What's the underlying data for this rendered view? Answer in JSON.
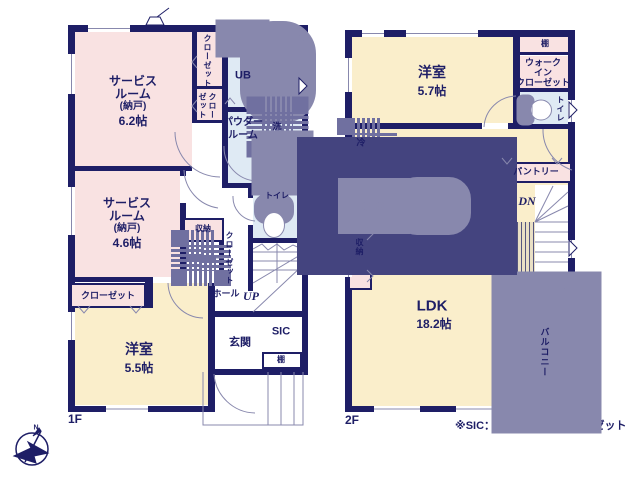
{
  "title": "Floor plan 1F/2F",
  "watermark": "ME Group",
  "footnote": "※SIC：シューズインクローゼット",
  "floor1_label": "1F",
  "floor2_label": "2F",
  "compass_label": "N",
  "colors": {
    "wall": "#1e1e66",
    "pink": "#f9e2e2",
    "yellow": "#faeecb",
    "blue": "#dfeaf4",
    "line": "#8888ad",
    "dash": "#7070a0",
    "tan": "#e9dfc4",
    "white": "#ffffff"
  },
  "rooms": [
    {
      "n": "room-service-6-2",
      "x": 75,
      "y": 32,
      "w": 117,
      "h": 136,
      "f": "pink"
    },
    {
      "n": "closet-column",
      "x": 197,
      "y": 32,
      "w": 25,
      "h": 91,
      "f": "pink"
    },
    {
      "n": "room-ub",
      "x": 228,
      "y": 32,
      "w": 73,
      "h": 75,
      "f": "blue"
    },
    {
      "n": "room-powder",
      "x": 228,
      "y": 112,
      "w": 73,
      "h": 71,
      "f": "blue"
    },
    {
      "n": "room-toilet-1f",
      "x": 253,
      "y": 188,
      "w": 48,
      "h": 50,
      "f": "blue"
    },
    {
      "n": "room-service-4-6",
      "x": 75,
      "y": 171,
      "w": 105,
      "h": 106,
      "f": "pink"
    },
    {
      "n": "room-youshitsu-5-5",
      "x": 75,
      "y": 283,
      "w": 133,
      "h": 122,
      "f": "yellow"
    },
    {
      "n": "room-youshitsu-5-7",
      "x": 352,
      "y": 37,
      "w": 161,
      "h": 86,
      "f": "yellow"
    },
    {
      "n": "room-ldk",
      "x": 352,
      "y": 129,
      "w": 160,
      "h": 277,
      "f": "yellow"
    },
    {
      "n": "room-ldk-wing",
      "x": 508,
      "y": 129,
      "w": 60,
      "h": 93,
      "f": "yellow"
    },
    {
      "n": "shelf-strip-2f",
      "x": 518,
      "y": 37,
      "w": 50,
      "h": 15,
      "f": "pink"
    },
    {
      "n": "room-wic",
      "x": 518,
      "y": 56,
      "w": 50,
      "h": 32,
      "f": "pink"
    },
    {
      "n": "room-toilet-2f",
      "x": 518,
      "y": 92,
      "w": 50,
      "h": 32,
      "f": "blue"
    },
    {
      "n": "stairs-2f-area",
      "x": 535,
      "y": 185,
      "w": 33,
      "h": 108,
      "f": "white"
    },
    {
      "n": "stairs-1f-area",
      "x": 253,
      "y": 243,
      "w": 48,
      "h": 68,
      "f": "white"
    }
  ],
  "walls": [
    [
      68,
      25,
      240,
      7
    ],
    [
      68,
      25,
      7,
      387
    ],
    [
      68,
      406,
      147,
      6
    ],
    [
      302,
      25,
      6,
      350
    ],
    [
      211,
      369,
      97,
      6
    ],
    [
      222,
      32,
      6,
      151
    ],
    [
      192,
      32,
      5,
      91
    ],
    [
      75,
      166,
      117,
      5
    ],
    [
      180,
      166,
      6,
      10
    ],
    [
      180,
      203,
      6,
      79
    ],
    [
      68,
      277,
      85,
      5
    ],
    [
      145,
      277,
      8,
      31
    ],
    [
      208,
      283,
      7,
      129
    ],
    [
      208,
      311,
      100,
      6
    ],
    [
      222,
      183,
      80,
      5
    ],
    [
      248,
      188,
      5,
      10
    ],
    [
      248,
      225,
      5,
      15
    ],
    [
      248,
      238,
      54,
      5
    ],
    [
      248,
      243,
      5,
      48
    ],
    [
      222,
      107,
      86,
      5
    ],
    [
      192,
      86,
      30,
      3
    ],
    [
      192,
      120,
      30,
      3
    ],
    [
      219,
      218,
      5,
      55
    ],
    [
      345,
      30,
      230,
      7
    ],
    [
      345,
      30,
      7,
      382
    ],
    [
      345,
      406,
      173,
      6
    ],
    [
      568,
      30,
      7,
      268
    ],
    [
      352,
      123,
      130,
      6
    ],
    [
      508,
      123,
      12,
      6
    ],
    [
      513,
      30,
      7,
      97
    ],
    [
      518,
      52,
      50,
      3
    ],
    [
      513,
      88,
      62,
      4
    ],
    [
      513,
      124,
      62,
      5
    ],
    [
      508,
      222,
      6,
      71
    ],
    [
      535,
      293,
      40,
      6
    ],
    [
      508,
      288,
      29,
      5
    ],
    [
      512,
      298,
      6,
      114
    ]
  ],
  "boxes": [
    {
      "n": "storage-box-1f",
      "x": 183,
      "y": 218,
      "w": 41,
      "h": 24,
      "f": "pink"
    },
    {
      "n": "closet-strip-1f",
      "x": 70,
      "y": 283,
      "w": 76,
      "h": 25,
      "f": "pink"
    },
    {
      "n": "shelf-box-entrance",
      "x": 262,
      "y": 352,
      "w": 40,
      "h": 17,
      "f": "white"
    },
    {
      "n": "pantry-box",
      "x": 500,
      "y": 162,
      "w": 72,
      "h": 21,
      "f": "pink"
    },
    {
      "n": "storage-box-2f",
      "x": 348,
      "y": 222,
      "w": 24,
      "h": 68,
      "f": "pink"
    }
  ],
  "stripe_panel": {
    "n": "stair-void-panel",
    "x": 514,
    "y": 222,
    "w": 21,
    "h": 66
  },
  "windows": [
    [
      88,
      25,
      42,
      7
    ],
    [
      68,
      54,
      7,
      40
    ],
    [
      68,
      187,
      7,
      48
    ],
    [
      68,
      312,
      7,
      28
    ],
    [
      106,
      406,
      42,
      6
    ],
    [
      301,
      76,
      7,
      20
    ],
    [
      362,
      30,
      22,
      7
    ],
    [
      406,
      30,
      72,
      7
    ],
    [
      345,
      58,
      7,
      34
    ],
    [
      345,
      243,
      7,
      34
    ],
    [
      374,
      406,
      46,
      6
    ],
    [
      456,
      406,
      58,
      6
    ],
    [
      568,
      100,
      7,
      22
    ],
    [
      568,
      240,
      7,
      18
    ],
    [
      512,
      316,
      6,
      74
    ]
  ],
  "vectors": [
    {
      "n": "window-line",
      "t": "p",
      "d": "M 88 28.5 H 130 M 362 33.5 H 384 M 406 33.5 H 478 M 106 409 H 148 M 374 409 H 420 M 456 409 H 514"
    },
    {
      "n": "window-line",
      "t": "p",
      "d": "M 71.5 54 V 94 M 71.5 187 V 235 M 71.5 312 V 340 M 304.5 76 V 96 M 348.5 58 V 92 M 348.5 243 V 277 M 571.5 100 V 122 M 571.5 240 V 258"
    },
    {
      "n": "balcony-door-line",
      "t": "p",
      "d": "M 515 316 V 390 M 512 353 H 518"
    },
    {
      "n": "porch-outline",
      "t": "p",
      "d": "M 203 372 V 425 H 303 V 372 M 268 372 V 425 M 281 372 V 425 M 294 372 V 425"
    },
    {
      "n": "balcony-outline",
      "t": "r",
      "x": 519,
      "y": 299,
      "w": 55,
      "h": 107,
      "f": "#ffffff"
    },
    {
      "n": "door-arc",
      "t": "p",
      "d": "M 175 132 A 45 45 0 0 0 220 177"
    },
    {
      "n": "door-arc",
      "t": "p",
      "d": "M 184 170 A 40 40 0 0 0 218 208"
    },
    {
      "n": "door-arc",
      "t": "p",
      "d": "M 224 146 A 34 34 0 0 0 257 181"
    },
    {
      "n": "door-arc",
      "t": "p",
      "d": "M 233 196 A 24 24 0 0 0 255 221"
    },
    {
      "n": "door-arc",
      "t": "p",
      "d": "M 214 374 A 42 42 0 0 0 255 413"
    },
    {
      "n": "door-arc",
      "t": "p",
      "d": "M 168 283 A 36 36 0 0 0 203 318"
    },
    {
      "n": "door-arc",
      "t": "p",
      "d": "M 484 127 A 33 33 0 0 1 516 96"
    },
    {
      "n": "door-arc",
      "t": "p",
      "d": "M 543 129 A 42 42 0 0 0 572 170"
    },
    {
      "n": "stairs-1f-lines",
      "t": "p",
      "d": "M 253 252 H 302 M 253 261 H 302 M 253 270 H 302 M 277 243 V 283 M 253 283 L 302 254 M 253 312 L 302 266"
    },
    {
      "n": "stairs-1f-break",
      "t": "p",
      "d": "M 253 249 L 262 244 L 268 250 L 277 244 L 284 250 L 293 245 L 302 249"
    },
    {
      "n": "stairs-2f-lines",
      "t": "p",
      "d": "M 535 222 H 568 M 535 232 H 568 M 535 242 H 568 M 535 252 H 568 M 535 262 H 568 M 535 272 H 568 M 535 282 H 568"
    },
    {
      "n": "stairs-2f-winders",
      "t": "p",
      "d": "M 535 222 L 553 186 M 535 222 L 568 192 M 535 222 L 568 206"
    },
    {
      "n": "stairs-2f-break",
      "t": "p",
      "d": "M 535 287 L 543 292 L 551 285 L 559 292 L 568 286"
    },
    {
      "n": "bathtub-icon",
      "t": "r",
      "x": 259,
      "y": 40,
      "w": 38,
      "h": 64,
      "rx": 14,
      "f": "#ffffff"
    },
    {
      "n": "bathtub-icon",
      "t": "r",
      "x": 263,
      "y": 44,
      "w": 30,
      "h": 56,
      "rx": 11
    },
    {
      "n": "bath-counter-icon",
      "t": "r",
      "x": 229,
      "y": 33,
      "w": 27,
      "h": 11,
      "f": "#ffffff"
    },
    {
      "n": "bath-faucet-icon",
      "t": "e",
      "cx": 237,
      "cy": 38.5,
      "rx": 3,
      "ry": 2.5
    },
    {
      "n": "washer-space-icon",
      "t": "r",
      "x": 262,
      "y": 112,
      "w": 31,
      "h": 30,
      "da": 1
    },
    {
      "n": "vanity-icon",
      "t": "r",
      "x": 267,
      "y": 146,
      "w": 31,
      "h": 34,
      "f": "#ffffff"
    },
    {
      "n": "vanity-bowl-icon",
      "t": "e",
      "cx": 282,
      "cy": 164,
      "rx": 11,
      "ry": 13
    },
    {
      "n": "vanity-tap-icon",
      "t": "r",
      "x": 278,
      "y": 147,
      "w": 8,
      "h": 5
    },
    {
      "n": "toilet-icon-1f",
      "t": "r",
      "x": 264,
      "y": 204,
      "w": 20,
      "h": 10,
      "rx": 2,
      "f": "#ffffff"
    },
    {
      "n": "toilet-icon-1f",
      "t": "e",
      "cx": 274,
      "cy": 225,
      "rx": 10.5,
      "ry": 12.5,
      "f": "#ffffff"
    },
    {
      "n": "closet-dash-1f",
      "t": "r",
      "x": 186,
      "y": 245,
      "w": 30,
      "h": 26,
      "da": 1
    },
    {
      "n": "closet-pointer-line",
      "t": "p",
      "d": "M 216 258 H 224"
    },
    {
      "n": "fridge-space-icon",
      "t": "r",
      "x": 352,
      "y": 133,
      "w": 30,
      "h": 31,
      "da": 1
    },
    {
      "n": "kitchen-counter-icon",
      "t": "r",
      "x": 352,
      "y": 192,
      "w": 110,
      "h": 28,
      "f": "#ffffff",
      "s": "#44447f"
    },
    {
      "n": "stove-icon",
      "t": "r",
      "x": 356,
      "y": 196,
      "w": 36,
      "h": 20
    },
    {
      "n": "stove-burner-icon",
      "t": "e",
      "cx": 366,
      "cy": 206,
      "rx": 4.5,
      "ry": 4.5
    },
    {
      "n": "stove-burner-icon",
      "t": "e",
      "cx": 366,
      "cy": 206,
      "rx": 1.8,
      "ry": 1.8
    },
    {
      "n": "stove-burner-icon",
      "t": "e",
      "cx": 380,
      "cy": 206,
      "rx": 4.5,
      "ry": 4.5
    },
    {
      "n": "stove-burner-icon",
      "t": "e",
      "cx": 380,
      "cy": 206,
      "rx": 1.8,
      "ry": 1.8
    },
    {
      "n": "sink-icon",
      "t": "r",
      "x": 414,
      "y": 196,
      "w": 38,
      "h": 20,
      "rx": 3,
      "f": "#ffffff"
    },
    {
      "n": "sink-faucet-icon",
      "t": "r",
      "x": 428,
      "y": 212,
      "w": 6,
      "h": 6
    },
    {
      "n": "sink-faucet-icon",
      "t": "p",
      "d": "M 434 215 H 443"
    },
    {
      "n": "toilet-icon-2f",
      "t": "r",
      "x": 521,
      "y": 99,
      "w": 9,
      "h": 22,
      "rx": 2,
      "f": "#ffffff"
    },
    {
      "n": "toilet-icon-2f",
      "t": "e",
      "cx": 541,
      "cy": 110,
      "rx": 10.5,
      "ry": 10,
      "f": "#ffffff"
    },
    {
      "n": "toilet-icon-2f",
      "t": "p",
      "d": "M 532 101 V 119"
    },
    {
      "n": "hanger-tick",
      "t": "p",
      "d": "M 78 306 L 84 313 L 90 306 M 130 306 L 136 313 L 142 306"
    },
    {
      "n": "hanger-tick",
      "t": "p",
      "d": "M 197 56 L 192 62 L 197 68 M 197 100 L 192 106 L 197 112"
    },
    {
      "n": "door-tick",
      "t": "p",
      "d": "M 225 104 L 230 98 L 235 104"
    },
    {
      "n": "hanger-tick",
      "t": "p",
      "d": "M 367 228 L 373 234 L 367 240 M 367 270 L 373 276 L 367 282"
    },
    {
      "n": "hanger-tick",
      "t": "p",
      "d": "M 502 158 L 507 164 L 512 158 M 552 158 L 557 164 L 562 158"
    },
    {
      "n": "louver-triangle",
      "t": "p",
      "d": "M 299 78 L 307 86 L 299 94 Z",
      "f": "#ffffff",
      "s": "#1e1e66"
    },
    {
      "n": "louver-triangle",
      "t": "p",
      "d": "M 569 102 L 577 110 L 569 118 Z",
      "f": "#ffffff",
      "s": "#1e1e66"
    },
    {
      "n": "louver-triangle",
      "t": "p",
      "d": "M 569 240 L 577 248 L 569 256 Z",
      "f": "#ffffff",
      "s": "#1e1e66"
    },
    {
      "n": "roof-vent-icon",
      "t": "p",
      "d": "M 146 25 L 150 17 L 160 17 L 164 25 Z",
      "f": "#ffffff",
      "s": "#1e1e66"
    },
    {
      "n": "roof-vent-icon",
      "t": "p",
      "d": "M 157 17 L 169 8",
      "s": "#1e1e66"
    },
    {
      "n": "compass-icon",
      "t": "e",
      "cx": 32,
      "cy": 449,
      "rx": 16,
      "ry": 16,
      "s": "#1e1e66",
      "w": 1.5
    },
    {
      "n": "compass-icon",
      "t": "p",
      "d": "M 14 456 L 31 448 L 28 442 L 48 453 L 34 456 L 36 463 Z",
      "f": "#1e1e66",
      "s": "#1e1e66"
    },
    {
      "n": "compass-icon",
      "t": "p",
      "d": "M 25 462 L 41 431",
      "s": "#1e1e66",
      "w": 1.5
    },
    {
      "n": "compass-icon",
      "t": "p",
      "d": "M 41 431 L 33 436 L 39 428 Z",
      "f": "#1e1e66",
      "s": "#1e1e66"
    }
  ],
  "labels": [
    {
      "n": "label-service-room1",
      "x": 133,
      "y": 81,
      "t": "サービス",
      "s": 12
    },
    {
      "n": "label-service-room1",
      "x": 133,
      "y": 94,
      "t": "ルーム",
      "s": 12
    },
    {
      "n": "label-service-room1",
      "x": 133,
      "y": 107,
      "t": "(納戸)",
      "s": 10
    },
    {
      "n": "label-service-room1-size",
      "x": 133,
      "y": 121,
      "t": "6.2帖",
      "s": 12
    },
    {
      "n": "label-closet1",
      "x": 207,
      "y": 61,
      "t": "クローゼット",
      "s": 8,
      "v": 1
    },
    {
      "n": "label-closet2",
      "x": 212,
      "y": 106,
      "t": "クロー",
      "s": 8,
      "v": 1
    },
    {
      "n": "label-closet2",
      "x": 202,
      "y": 106,
      "t": "ゼット",
      "s": 8,
      "v": 1
    },
    {
      "n": "label-ub",
      "x": 243,
      "y": 76,
      "t": "UB",
      "s": 11
    },
    {
      "n": "label-powder-room",
      "x": 243,
      "y": 123,
      "t": "パウダー",
      "s": 10
    },
    {
      "n": "label-powder-room",
      "x": 243,
      "y": 136,
      "t": "ルーム",
      "s": 10
    },
    {
      "n": "label-washer",
      "x": 277,
      "y": 127,
      "t": "洗",
      "s": 9
    },
    {
      "n": "label-service-room2",
      "x": 127,
      "y": 203,
      "t": "サービス",
      "s": 12
    },
    {
      "n": "label-service-room2",
      "x": 127,
      "y": 216,
      "t": "ルーム",
      "s": 12
    },
    {
      "n": "label-service-room2",
      "x": 127,
      "y": 229,
      "t": "(納戸)",
      "s": 10
    },
    {
      "n": "label-service-room2-size",
      "x": 127,
      "y": 243,
      "t": "4.6帖",
      "s": 12
    },
    {
      "n": "label-storage-1f",
      "x": 203,
      "y": 229,
      "t": "収納",
      "s": 8
    },
    {
      "n": "label-closet-hall",
      "x": 229,
      "y": 258,
      "t": "クローゼット",
      "s": 8,
      "v": 1
    },
    {
      "n": "label-toilet-1f",
      "x": 277,
      "y": 196,
      "t": "トイレ",
      "s": 8
    },
    {
      "n": "label-hall",
      "x": 226,
      "y": 294,
      "t": "ホール",
      "s": 9
    },
    {
      "n": "label-stairs-up",
      "x": 251,
      "y": 296,
      "t": "UP",
      "s": 12,
      "i": 1
    },
    {
      "n": "label-genkan",
      "x": 240,
      "y": 343,
      "t": "玄関",
      "s": 11
    },
    {
      "n": "label-sic",
      "x": 281,
      "y": 332,
      "t": "SIC",
      "s": 11
    },
    {
      "n": "label-shelf-1f",
      "x": 281,
      "y": 360,
      "t": "棚",
      "s": 8
    },
    {
      "n": "label-closet-strip",
      "x": 108,
      "y": 296,
      "t": "クローゼット",
      "s": 9
    },
    {
      "n": "label-youshitsu-55",
      "x": 139,
      "y": 349,
      "t": "洋室",
      "s": 14
    },
    {
      "n": "label-youshitsu-55-size",
      "x": 139,
      "y": 368,
      "t": "5.5帖",
      "s": 12
    },
    {
      "n": "label-youshitsu-57",
      "x": 432,
      "y": 72,
      "t": "洋室",
      "s": 14
    },
    {
      "n": "label-youshitsu-57-size",
      "x": 432,
      "y": 91,
      "t": "5.7帖",
      "s": 12
    },
    {
      "n": "label-shelf-2f",
      "x": 545,
      "y": 44,
      "t": "棚",
      "s": 8
    },
    {
      "n": "label-wic",
      "x": 543,
      "y": 63,
      "t": "ウォーク",
      "s": 9
    },
    {
      "n": "label-wic",
      "x": 543,
      "y": 73,
      "t": "イン",
      "s": 9
    },
    {
      "n": "label-wic",
      "x": 543,
      "y": 83,
      "t": "クローゼット",
      "s": 9
    },
    {
      "n": "label-toilet-2f",
      "x": 560,
      "y": 109,
      "t": "トイレ",
      "s": 8,
      "v": 1
    },
    {
      "n": "label-fridge",
      "x": 361,
      "y": 143,
      "t": "冷",
      "s": 9
    },
    {
      "n": "label-pantry",
      "x": 536,
      "y": 172,
      "t": "パントリー",
      "s": 9
    },
    {
      "n": "label-stairs-dn",
      "x": 527,
      "y": 201,
      "t": "DN",
      "s": 12,
      "i": 1
    },
    {
      "n": "label-storage-2f",
      "x": 359,
      "y": 247,
      "t": "収納",
      "s": 8,
      "v": 1
    },
    {
      "n": "label-ldk",
      "x": 432,
      "y": 306,
      "t": "LDK",
      "s": 15
    },
    {
      "n": "label-ldk-size",
      "x": 434,
      "y": 324,
      "t": "18.2帖",
      "s": 12
    },
    {
      "n": "label-balcony",
      "x": 544,
      "y": 352,
      "t": "バルコニー",
      "s": 9,
      "v": 1
    },
    {
      "n": "label-compass-n",
      "x": 36,
      "y": 428,
      "t": "N",
      "s": 7
    }
  ]
}
